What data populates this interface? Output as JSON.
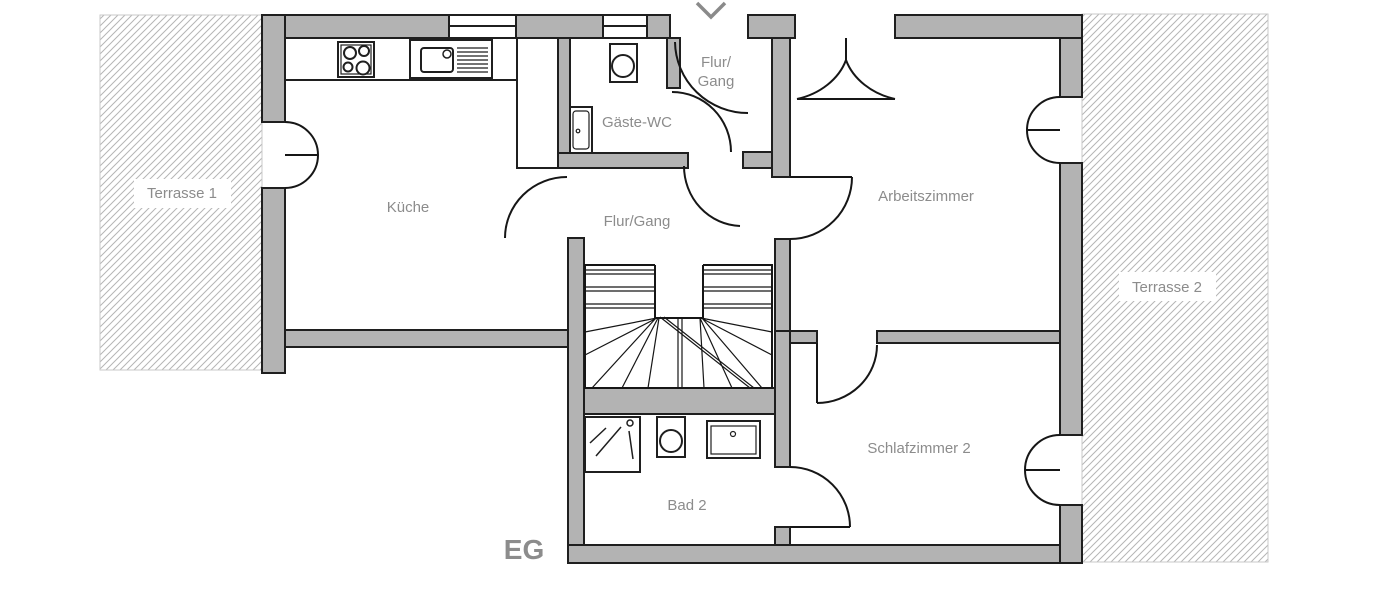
{
  "floorplan": {
    "floor_label": "EG",
    "rooms": {
      "terrasse1": {
        "label": "Terrasse 1"
      },
      "kueche": {
        "label": "Küche"
      },
      "gaeste_wc": {
        "label": "Gäste-WC"
      },
      "flur_gang_top": {
        "line1": "Flur/",
        "line2": "Gang"
      },
      "flur_gang": {
        "label": "Flur/Gang"
      },
      "arbeitszimmer": {
        "label": "Arbeitszimmer"
      },
      "terrasse2": {
        "label": "Terrasse 2"
      },
      "schlafzimmer2": {
        "label": "Schlafzimmer 2"
      },
      "bad2": {
        "label": "Bad 2"
      }
    },
    "fixtures": [
      "stove-icon",
      "kitchen-sink-icon",
      "tall-cabinet",
      "toilet-icon",
      "washbasin-icon",
      "shower-icon",
      "staircase",
      "entrance-arrow"
    ],
    "colors": {
      "wall_fill": "#b3b3b3",
      "outline": "#1f1f1f",
      "label_text": "#8c8c8c",
      "hatch_line": "#b5b5b5",
      "terrace_border": "#c9c9c9",
      "arrow": "#8a8a8a"
    }
  }
}
